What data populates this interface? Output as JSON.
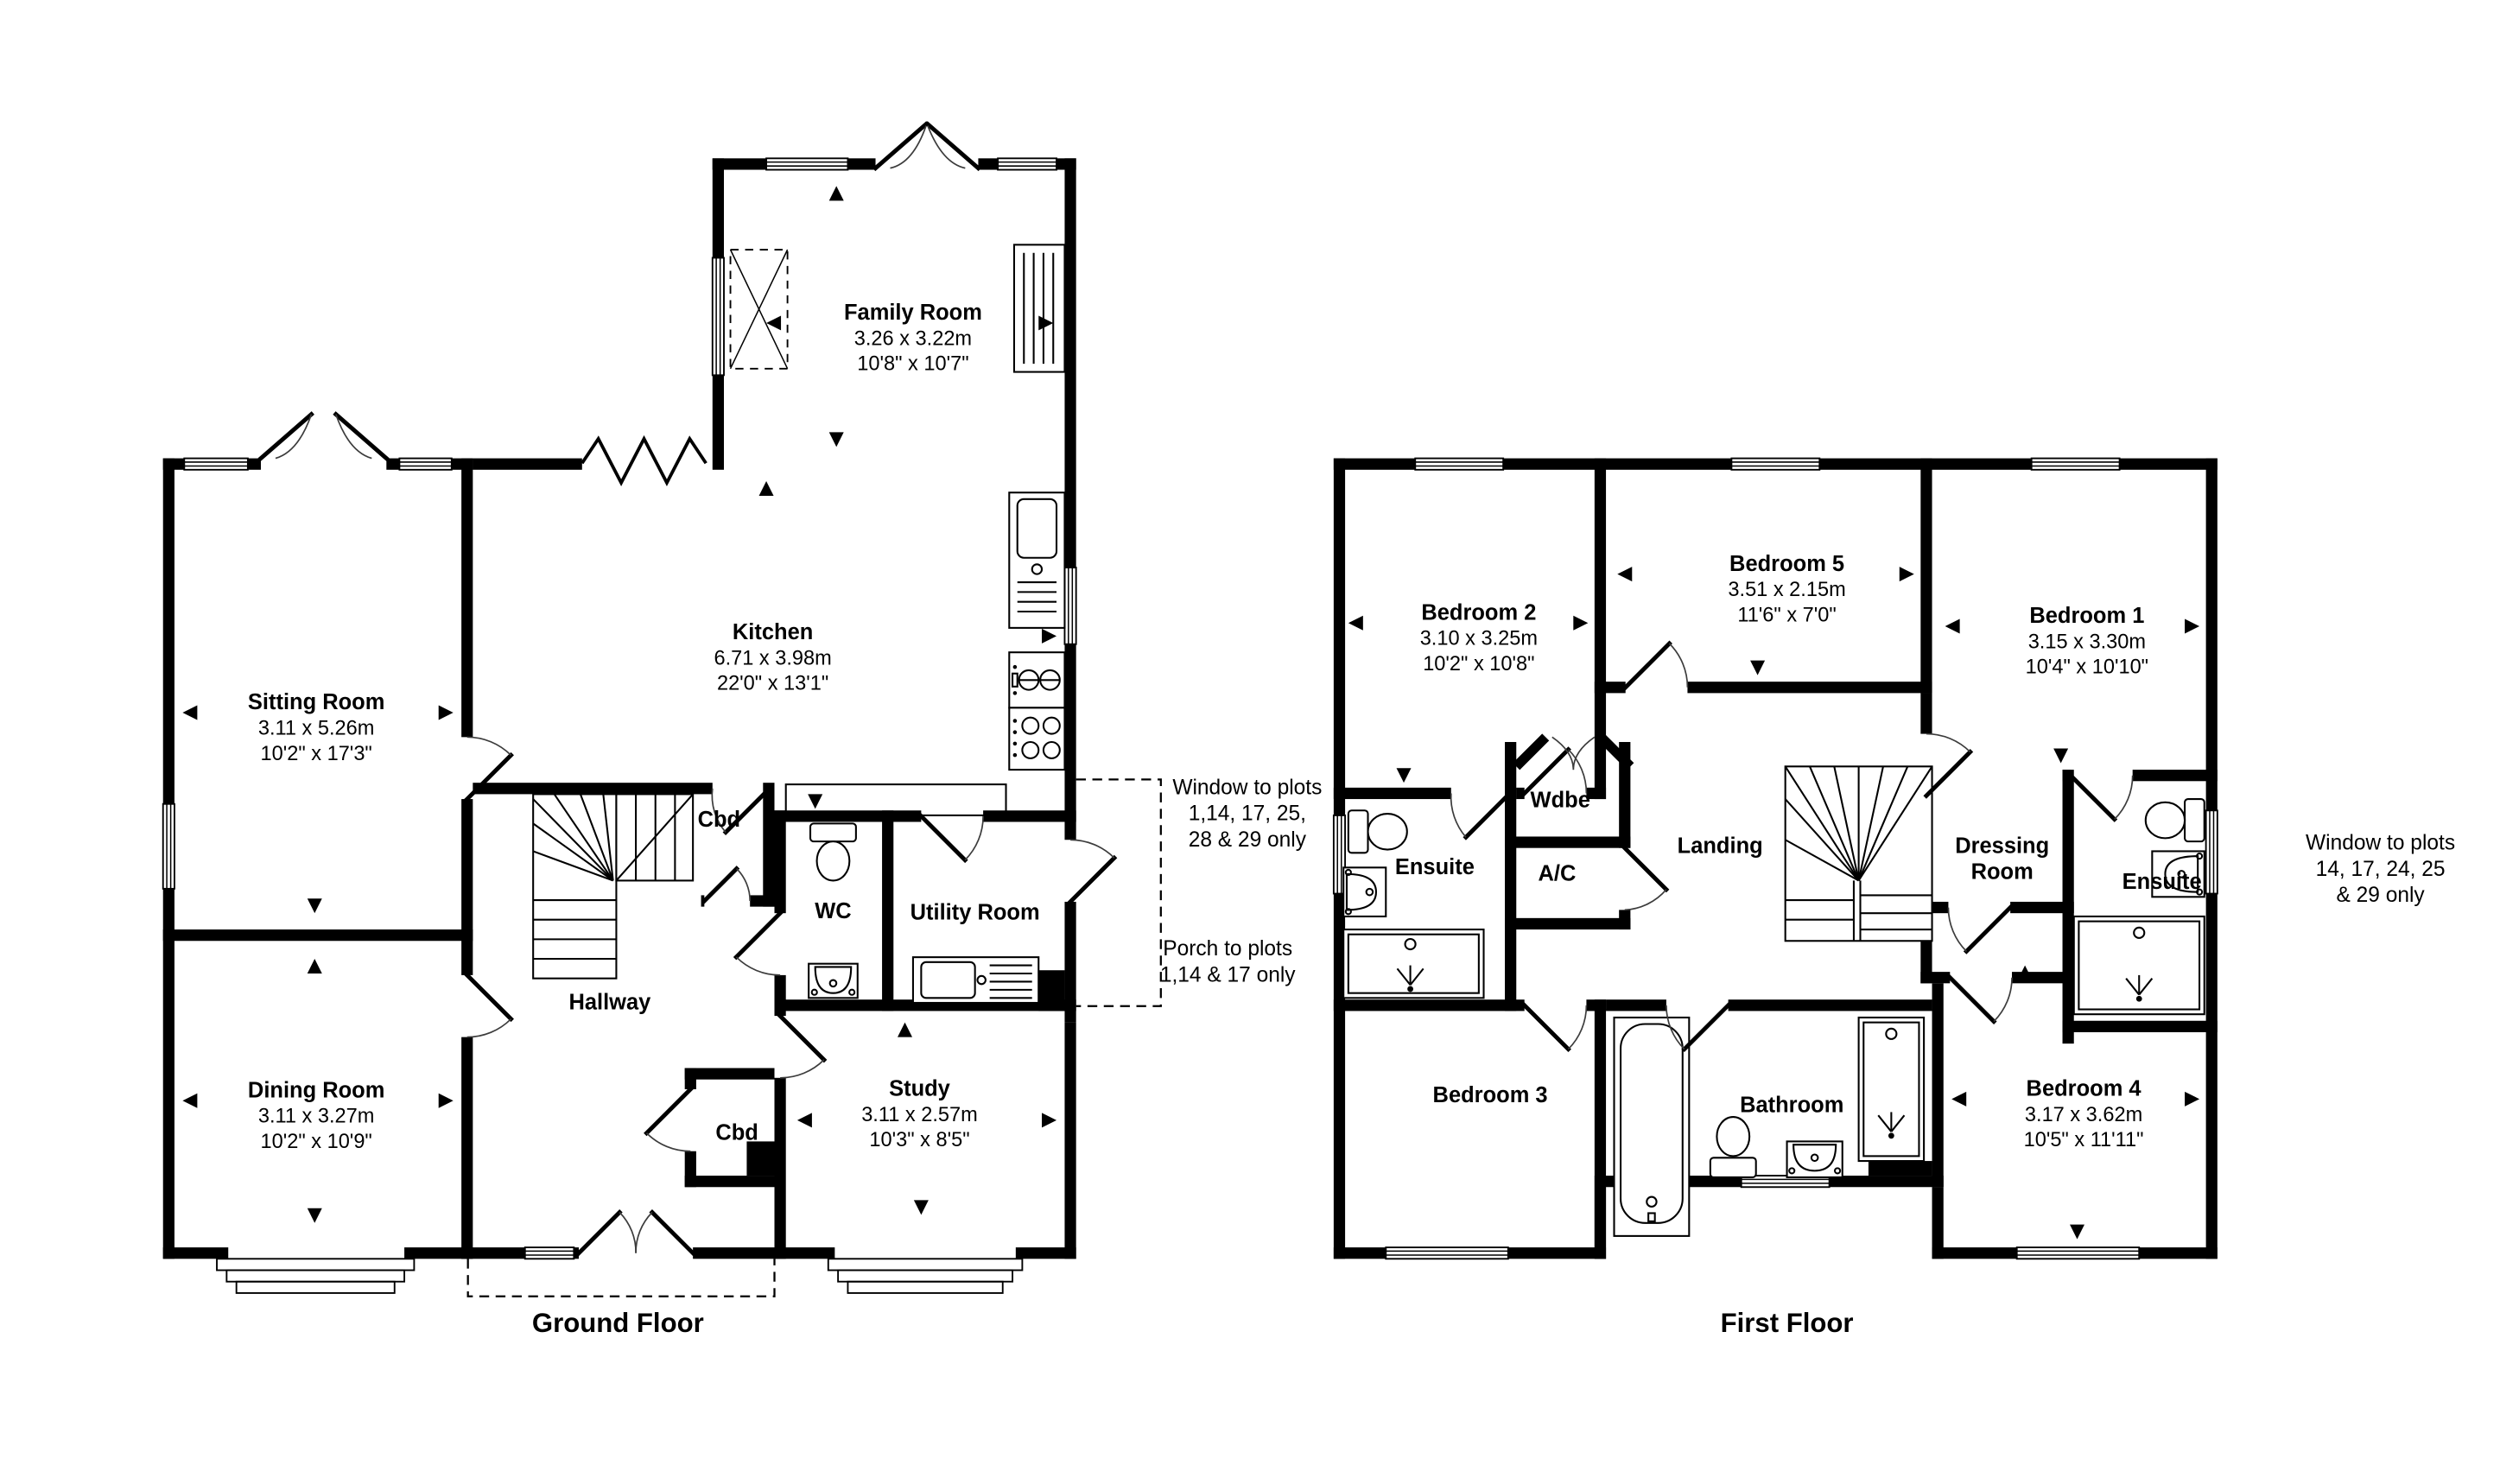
{
  "page": {
    "background": "#ffffff",
    "wall_color": "#000000"
  },
  "ground_floor": {
    "label": "Ground Floor",
    "rooms": {
      "family_room": {
        "name": "Family Room",
        "metric": "3.26 x 3.22m",
        "imperial": "10'8\" x 10'7\""
      },
      "sitting_room": {
        "name": "Sitting Room",
        "metric": "3.11 x 5.26m",
        "imperial": "10'2\" x 17'3\""
      },
      "kitchen": {
        "name": "Kitchen",
        "metric": "6.71 x 3.98m",
        "imperial": "22'0\" x 13'1\""
      },
      "dining_room": {
        "name": "Dining Room",
        "metric": "3.11 x 3.27m",
        "imperial": "10'2\" x 10'9\""
      },
      "study": {
        "name": "Study",
        "metric": "3.11 x 2.57m",
        "imperial": "10'3\" x 8'5\""
      },
      "hallway": {
        "name": "Hallway"
      },
      "wc": {
        "name": "WC"
      },
      "utility_room": {
        "name": "Utility Room"
      },
      "cupboard_understairs": {
        "name": "Cbd"
      },
      "cupboard_entrance": {
        "name": "Cbd"
      }
    },
    "notes": {
      "window": {
        "line1": "Window to plots",
        "line2": "1,14, 17, 25,",
        "line3": "28 & 29 only"
      },
      "porch": {
        "line1": "Porch to plots",
        "line2": "1,14 & 17 only"
      }
    }
  },
  "first_floor": {
    "label": "First Floor",
    "rooms": {
      "bedroom_1": {
        "name": "Bedroom 1",
        "metric": "3.15 x 3.30m",
        "imperial": "10'4\" x 10'10\""
      },
      "bedroom_2": {
        "name": "Bedroom 2",
        "metric": "3.10 x 3.25m",
        "imperial": "10'2\" x 10'8\""
      },
      "bedroom_3": {
        "name": "Bedroom 3"
      },
      "bedroom_4": {
        "name": "Bedroom 4",
        "metric": "3.17 x 3.62m",
        "imperial": "10'5\" x 11'11\""
      },
      "bedroom_5": {
        "name": "Bedroom 5",
        "metric": "3.51 x 2.15m",
        "imperial": "11'6\" x 7'0\""
      },
      "landing": {
        "name": "Landing"
      },
      "ensuite_left": {
        "name": "Ensuite"
      },
      "ensuite_right": {
        "name": "Ensuite"
      },
      "wardrobe": {
        "name": "Wdbe"
      },
      "airing_cupboard": {
        "name": "A/C"
      },
      "dressing_room": {
        "line1": "Dressing",
        "line2": "Room"
      },
      "bathroom": {
        "name": "Bathroom"
      }
    },
    "notes": {
      "window": {
        "line1": "Window to plots",
        "line2": "14, 17, 24, 25",
        "line3": "& 29 only"
      }
    }
  }
}
